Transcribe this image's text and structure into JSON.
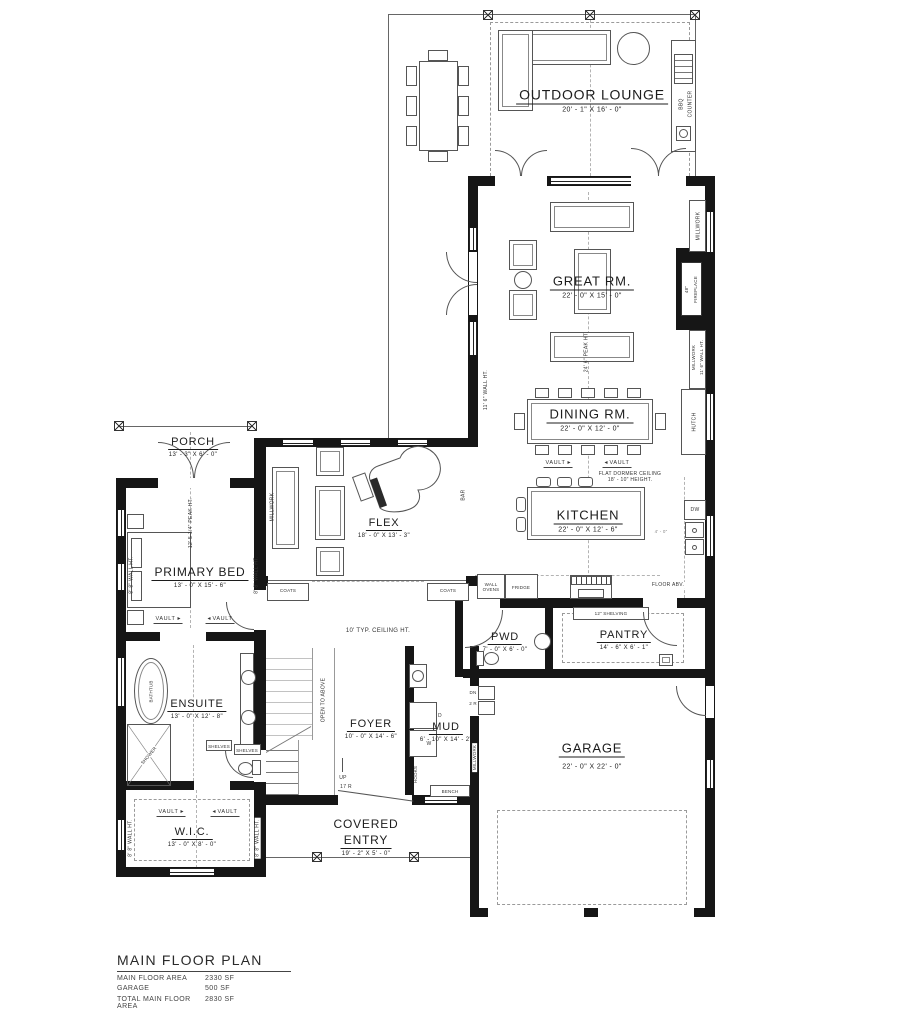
{
  "rooms": {
    "outdoor_lounge": {
      "name": "OUTDOOR LOUNGE",
      "dims": "20' - 1\" X 16' - 0\""
    },
    "great_rm": {
      "name": "GREAT RM.",
      "dims": "22' - 0\" X 15' - 0\""
    },
    "dining_rm": {
      "name": "DINING RM.",
      "dims": "22' - 0\" X 12' - 0\""
    },
    "kitchen": {
      "name": "KITCHEN",
      "dims": "22' - 0\" X 12' - 6\""
    },
    "porch": {
      "name": "PORCH",
      "dims": "13' - 3\" X 6' - 0\""
    },
    "primary_bed": {
      "name": "PRIMARY BED",
      "dims": "13' - 0\" X 15' - 6\""
    },
    "flex": {
      "name": "FLEX",
      "dims": "18' - 0\" X 13' - 3\""
    },
    "ensuite": {
      "name": "ENSUITE",
      "dims": "13' - 0\" X 12' - 8\""
    },
    "wic": {
      "name": "W.I.C.",
      "dims": "13' - 0\" X 8' - 0\""
    },
    "foyer": {
      "name": "FOYER",
      "dims": "10' - 0\" X 14' - 6\""
    },
    "mud": {
      "name": "MUD",
      "dims": "6' - 10\" X 14' - 2\""
    },
    "pwd": {
      "name": "PWD",
      "dims": "7' - 0\" X 6' - 0\""
    },
    "pantry": {
      "name": "PANTRY",
      "dims": "14' - 6\" X 6' - 1\""
    },
    "garage": {
      "name": "GARAGE",
      "dims": "22' - 0\" X 22' - 0\""
    },
    "covered_entry": {
      "name_line1": "COVERED",
      "name_line2": "ENTRY",
      "dims": "19' - 2\" X 5' - 0\""
    }
  },
  "annotations": {
    "bbq_line1": "BBQ",
    "bbq_line2": "COUNTER",
    "millwork": "MILLWORK",
    "wall_ht_11_6": "11' 6\" WALL HT.",
    "peak_ht_24_6": "24' 6\" PEAK HT.",
    "peak_ht_12_5": "12' 5 1/4\" PEAK HT.",
    "wall_ht_8_8": "8' 8\" WALL HT.",
    "fireplace_48": "48\"",
    "fireplace_name": "FIREPLACE",
    "hutch": "HUTCH",
    "vault": "VAULT",
    "flat_dormer_1": "FLAT DORMER CEILING",
    "flat_dormer_2": "18' - 10\" HEIGHT.",
    "dw": "DW",
    "fridge": "FRIDGE",
    "wall_ovens_1": "WALL",
    "wall_ovens_2": "OVENS",
    "floor_abv": "FLOOR ABV.",
    "shelving_12": "12\" SHELVING",
    "clearance_4_0": "4' - 0\"",
    "coats": "COATS",
    "bar": "BAR",
    "bathtub": "BATHTUB",
    "shower": "SHOWER",
    "shelves": "SHELVES",
    "ceiling_ht_10": "10' TYP. CEILING HT.",
    "open_to_above": "OPEN TO ABOVE",
    "up": "UP",
    "r17": "17 R",
    "dn": "DN",
    "r2": "2 R",
    "hooks": "HOOKS",
    "bench": "BENCH",
    "d": "D",
    "w": "W"
  },
  "icons": {
    "arrow_right": "▸",
    "arrow_left": "◂"
  },
  "legend": {
    "title": "MAIN FLOOR PLAN",
    "rows": [
      {
        "label": "MAIN FLOOR AREA",
        "value": "2330 SF"
      },
      {
        "label": "GARAGE",
        "value": "500 SF"
      },
      {
        "label": "TOTAL MAIN FLOOR AREA",
        "value": "2830 SF"
      }
    ]
  }
}
